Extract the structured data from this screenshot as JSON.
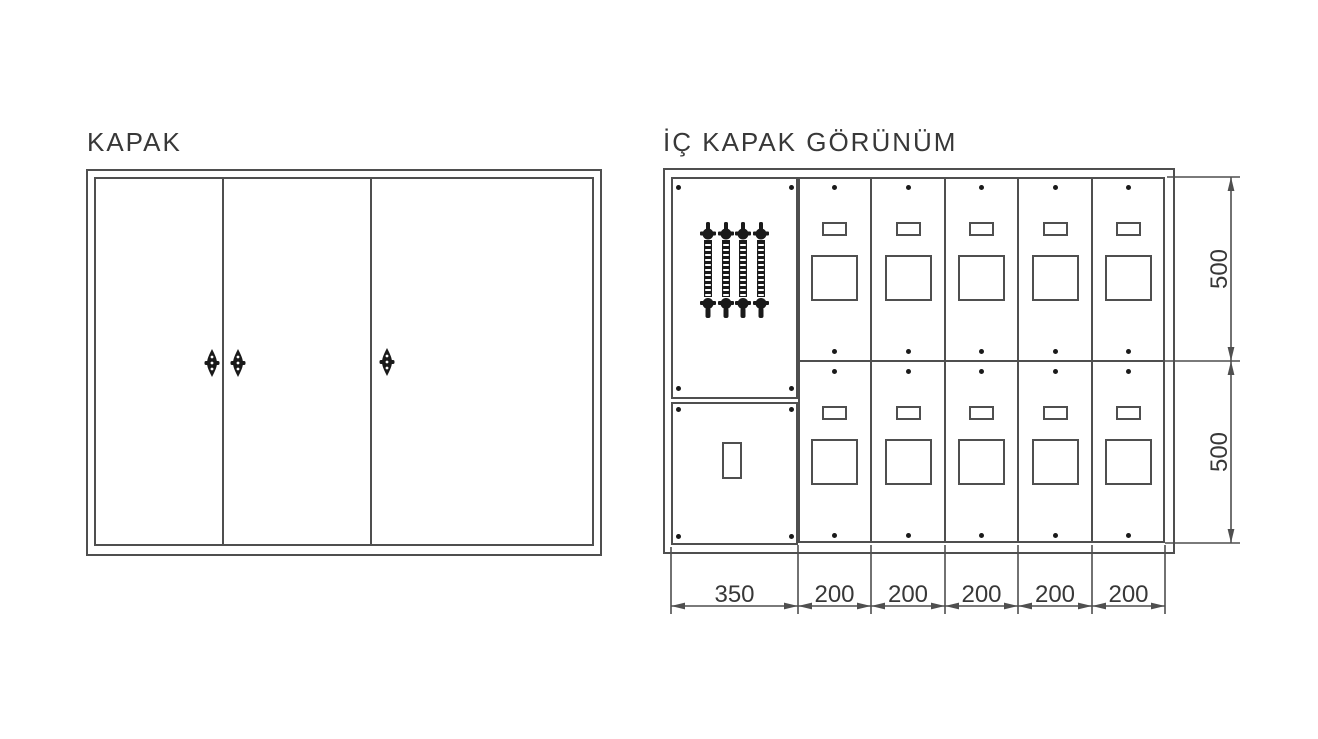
{
  "drawing": {
    "left_view": {
      "title": "KAPAK"
    },
    "right_view": {
      "title": "İÇ KAPAK GÖRÜNÜM"
    },
    "dims": {
      "vertical": [
        "500",
        "500"
      ],
      "horizontal": [
        "350",
        "200",
        "200",
        "200",
        "200",
        "200"
      ]
    }
  },
  "colors": {
    "background": "#ffffff",
    "line": "#4f4f4f",
    "text": "#383838",
    "hardware": "#1a1a1a"
  }
}
